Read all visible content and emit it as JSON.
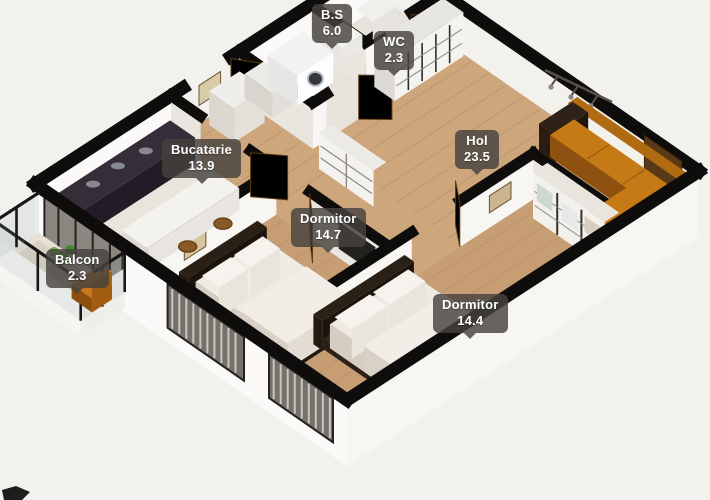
{
  "rooms": [
    {
      "id": "bs",
      "name": "B.S",
      "area": "6.0"
    },
    {
      "id": "wc",
      "name": "WC",
      "area": "2.3"
    },
    {
      "id": "bucatarie",
      "name": "Bucatarie",
      "area": "13.9"
    },
    {
      "id": "hol",
      "name": "Hol",
      "area": "23.5"
    },
    {
      "id": "dormitor1",
      "name": "Dormitor",
      "area": "14.7"
    },
    {
      "id": "dormitor2",
      "name": "Dormitor",
      "area": "14.4"
    },
    {
      "id": "balcon",
      "name": "Balcon",
      "area": "2.3"
    }
  ],
  "colors": {
    "background": "#f2f1ee",
    "wall_top": "#0e0d0c",
    "wall_face_bright": "#f7f6f2",
    "wall_face_shaded": "#e9e6e0",
    "floor_wood": "#c79e73",
    "floor_light": "#e9e4dc",
    "sofa_orange": "#c67a16",
    "door_brown": "#8a5a20",
    "plant_green": "#4e9c34",
    "chair_orange": "#c8771d",
    "label_bg": "rgba(70,66,62,0.82)",
    "label_text": "#ffffff"
  }
}
